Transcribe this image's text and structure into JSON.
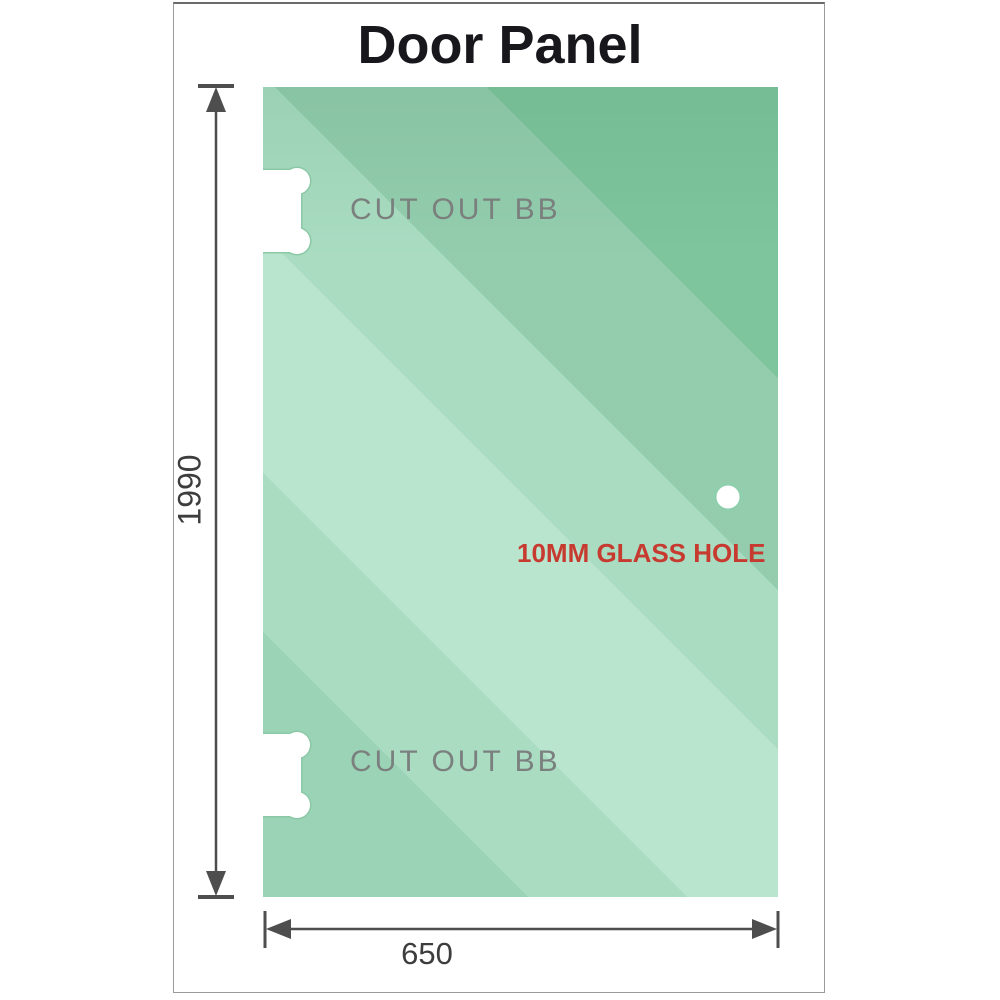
{
  "title": "Door Panel",
  "panel": {
    "description": "green glass door panel",
    "cutouts": [
      {
        "label": "CUT OUT BB",
        "position": "top-left-edge"
      },
      {
        "label": "CUT OUT BB",
        "position": "bottom-left-edge"
      }
    ],
    "glass_hole": {
      "label": "10MM GLASS HOLE"
    }
  },
  "dimensions": {
    "height": {
      "value": "1990",
      "orientation": "vertical-left"
    },
    "width": {
      "value": "650",
      "orientation": "horizontal-bottom"
    }
  },
  "colors": {
    "glass_green_dark": "#7ec49c",
    "glass_green_mid": "#93cdae",
    "glass_green_light": "#b9e4cd",
    "cutout_label_gray": "#7b807e",
    "hole_label_red": "#c73a30",
    "dimension_line_gray": "#4e4e4e",
    "title_black": "#17171c",
    "frame_border_gray": "#9a9a9a"
  }
}
